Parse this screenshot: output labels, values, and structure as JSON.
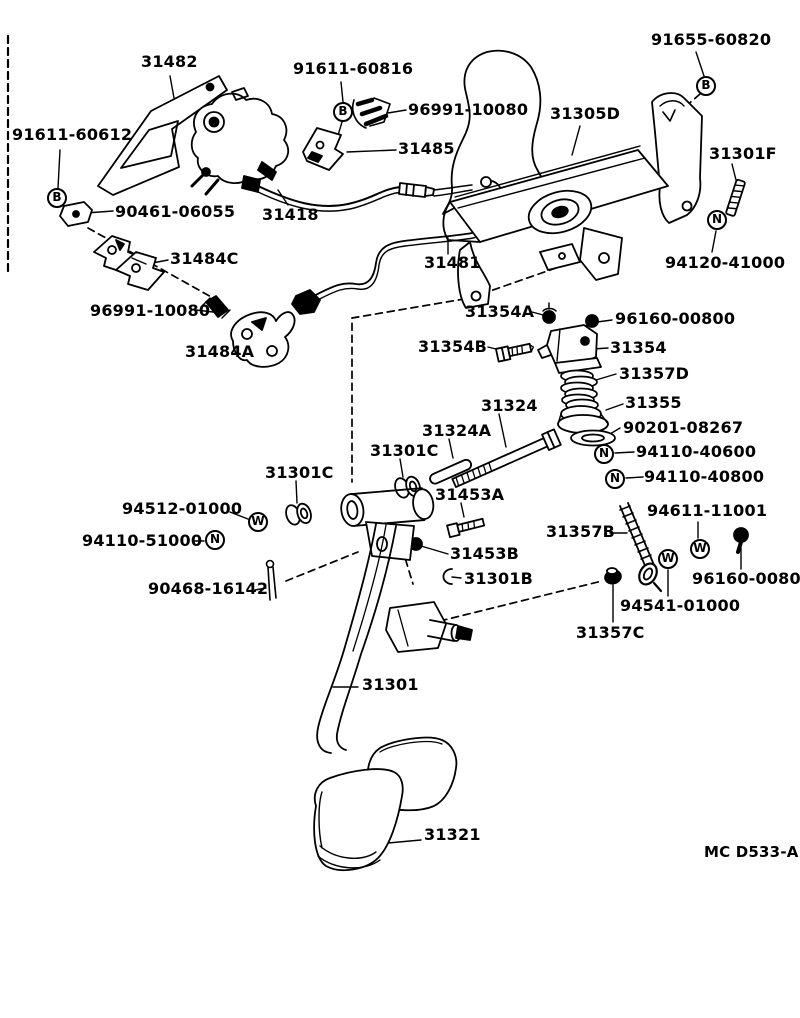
{
  "diagram": {
    "footer_code": "MC D533-A",
    "ink_color": "#000000",
    "background_color": "#ffffff"
  },
  "labels": [
    {
      "text": "31482",
      "x": 141,
      "y": 53
    },
    {
      "text": "91611-60612",
      "x": 12,
      "y": 126
    },
    {
      "text": "90461-06055",
      "x": 115,
      "y": 203
    },
    {
      "text": "31484C",
      "x": 170,
      "y": 250
    },
    {
      "text": "96991-10080",
      "x": 90,
      "y": 302
    },
    {
      "text": "31484A",
      "x": 185,
      "y": 343
    },
    {
      "text": "91611-60816",
      "x": 293,
      "y": 60
    },
    {
      "text": "96991-10080",
      "x": 408,
      "y": 101
    },
    {
      "text": "31485",
      "x": 398,
      "y": 140
    },
    {
      "text": "31418",
      "x": 262,
      "y": 206
    },
    {
      "text": "31481",
      "x": 424,
      "y": 254
    },
    {
      "text": "91655-60820",
      "x": 651,
      "y": 31
    },
    {
      "text": "31305D",
      "x": 550,
      "y": 105
    },
    {
      "text": "31301F",
      "x": 709,
      "y": 145
    },
    {
      "text": "94120-41000",
      "x": 665,
      "y": 254
    },
    {
      "text": "31354A",
      "x": 465,
      "y": 303
    },
    {
      "text": "96160-00800",
      "x": 615,
      "y": 310
    },
    {
      "text": "31354B",
      "x": 418,
      "y": 338
    },
    {
      "text": "31354",
      "x": 610,
      "y": 339
    },
    {
      "text": "31357D",
      "x": 619,
      "y": 365
    },
    {
      "text": "31355",
      "x": 625,
      "y": 394
    },
    {
      "text": "90201-08267",
      "x": 623,
      "y": 419
    },
    {
      "text": "31324",
      "x": 481,
      "y": 397
    },
    {
      "text": "31324A",
      "x": 422,
      "y": 422
    },
    {
      "text": "94110-40600",
      "x": 636,
      "y": 443
    },
    {
      "text": "31301C",
      "x": 370,
      "y": 442
    },
    {
      "text": "94110-40800",
      "x": 644,
      "y": 468
    },
    {
      "text": "31301C",
      "x": 265,
      "y": 464
    },
    {
      "text": "31453A",
      "x": 435,
      "y": 486
    },
    {
      "text": "94512-01000",
      "x": 122,
      "y": 500
    },
    {
      "text": "94611-11001",
      "x": 647,
      "y": 502
    },
    {
      "text": "31357B",
      "x": 546,
      "y": 523
    },
    {
      "text": "94110-51000",
      "x": 82,
      "y": 532
    },
    {
      "text": "31453B",
      "x": 450,
      "y": 545
    },
    {
      "text": "96160-00800",
      "x": 692,
      "y": 570
    },
    {
      "text": "90468-16142",
      "x": 148,
      "y": 580
    },
    {
      "text": "31301B",
      "x": 464,
      "y": 570
    },
    {
      "text": "94541-01000",
      "x": 620,
      "y": 597
    },
    {
      "text": "31357C",
      "x": 576,
      "y": 624
    },
    {
      "text": "31301",
      "x": 362,
      "y": 676
    },
    {
      "text": "31321",
      "x": 424,
      "y": 826
    }
  ],
  "fasteners": [
    {
      "letter": "B",
      "x": 57,
      "y": 198
    },
    {
      "letter": "B",
      "x": 343,
      "y": 112
    },
    {
      "letter": "B",
      "x": 706,
      "y": 86
    },
    {
      "letter": "N",
      "x": 717,
      "y": 220
    },
    {
      "letter": "N",
      "x": 604,
      "y": 454
    },
    {
      "letter": "N",
      "x": 615,
      "y": 479
    },
    {
      "letter": "W",
      "x": 258,
      "y": 522
    },
    {
      "letter": "N",
      "x": 215,
      "y": 540
    },
    {
      "letter": "W",
      "x": 668,
      "y": 559
    },
    {
      "letter": "W",
      "x": 700,
      "y": 549
    }
  ]
}
